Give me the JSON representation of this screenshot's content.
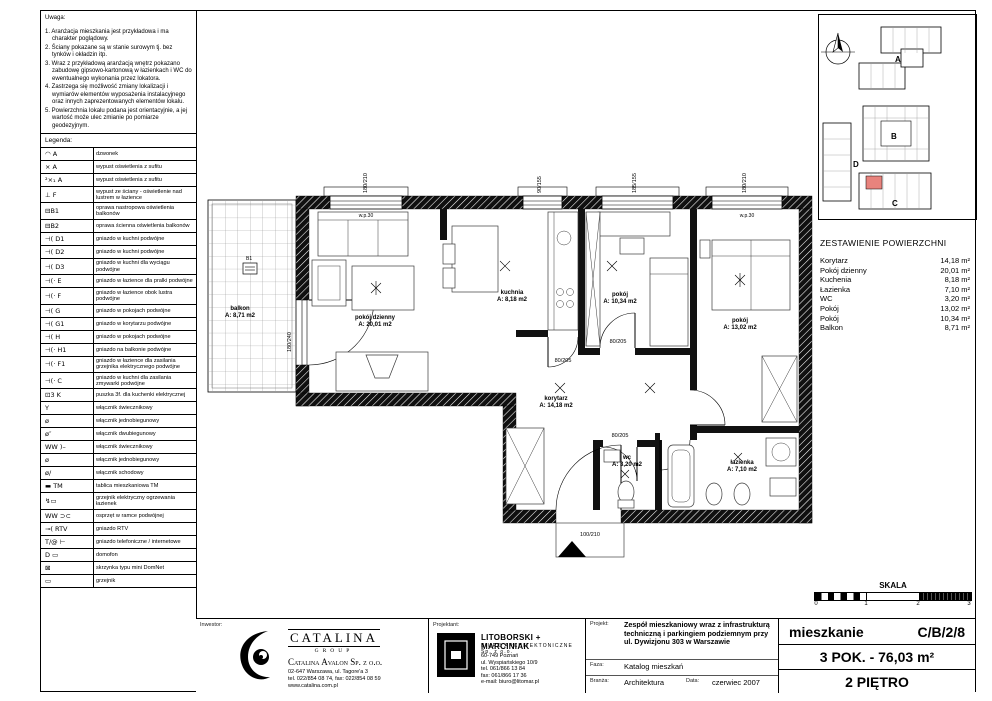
{
  "notes": {
    "title": "Uwaga:",
    "items": [
      "1. Aranżacja mieszkania jest przykładowa i ma charakter poglądowy.",
      "2. Ściany pokazane są w stanie surowym tj. bez tynków i okładzin itp.",
      "3. Wraz z przykładową aranżacją wnętrz pokazano zabudowę gipsowo-kartonową w łazienkach i WC do ewentualnego wykonania przez lokatora.",
      "4. Zastrzega się możliwość zmiany lokalizacji i wymiarów elementów wyposażenia instalacyjnego oraz innych zaprezentowanych elementów lokalu.",
      "5. Powierzchnia lokalu podana jest orientacyjnie, a jej wartość może ulec zmianie po pomiarze geodezyjnym."
    ]
  },
  "legend": {
    "title": "Legenda:",
    "rows": [
      {
        "sym": "◠ A",
        "desc": "dzwonek"
      },
      {
        "sym": "× A",
        "desc": "wypust oświetlenia z sufitu"
      },
      {
        "sym": "²×₁ A",
        "desc": "wypust oświetlenia z sufitu"
      },
      {
        "sym": "⊥ F",
        "desc": "wypust ze ściany - oświetlenie nad lustrem w łazience"
      },
      {
        "sym": "⊟B1",
        "desc": "oprawa nastropowa oświetlenia balkonów"
      },
      {
        "sym": "⊟B2",
        "desc": "oprawa ścienna oświetlenia balkonów"
      },
      {
        "sym": "⊣( D1",
        "desc": "gniazdo w kuchni podwójne"
      },
      {
        "sym": "⊣( D2",
        "desc": "gniazdo w kuchni podwójne"
      },
      {
        "sym": "⊣( D3",
        "desc": "gniazdo w kuchni dla wyciągu podwójne"
      },
      {
        "sym": "⊣(⋅ E",
        "desc": "gniazdo w łazience dla pralki podwójne"
      },
      {
        "sym": "⊣(⋅ F",
        "desc": "gniazdo w łazience obok lustra podwójne"
      },
      {
        "sym": "⊣( G",
        "desc": "gniazdo w pokojach podwójne"
      },
      {
        "sym": "⊣( G1",
        "desc": "gniazdo w korytarzu podwójne"
      },
      {
        "sym": "⊣( H",
        "desc": "gniazdo w pokojach podwójne"
      },
      {
        "sym": "⊣(⋅ H1",
        "desc": "gniazdo na balkonie podwójne"
      },
      {
        "sym": "⊣(⋅ F1",
        "desc": "gniazdo w łazience dla zasilania grzejnika elektrycznego podwójne"
      },
      {
        "sym": "⊣(⋅ C",
        "desc": "gniazdo w kuchni dla zasilania zmywarki podwójne"
      },
      {
        "sym": "⊡3 K",
        "desc": "puszka 3f. dla kuchenki elektrycznej"
      },
      {
        "sym": "Y",
        "desc": "włącznik świecznikowy"
      },
      {
        "sym": "ø",
        "desc": "włącznik jednobiegunowy"
      },
      {
        "sym": "ø″",
        "desc": "włącznik dwubiegunowy"
      },
      {
        "sym": "WW )–",
        "desc": "włącznik świecznikowy"
      },
      {
        "sym": "ø",
        "desc": "włącznik jednobiegunowy"
      },
      {
        "sym": "ø/",
        "desc": "włącznik schodowy"
      },
      {
        "sym": "▬ TM",
        "desc": "tablica mieszkaniowa TM"
      },
      {
        "sym": "↯▭",
        "desc": "grzejnik elektryczny ogrzewania łazienek"
      },
      {
        "sym": "WW ⊃⊂",
        "desc": "osprzęt w ramce podwójnej"
      },
      {
        "sym": "⊸( RTV",
        "desc": "gniazdo RTV"
      },
      {
        "sym": "T/@ ⊢",
        "desc": "gniazdo telefoniczne / internetowe"
      },
      {
        "sym": "D ▭",
        "desc": "domofon"
      },
      {
        "sym": "⊠",
        "desc": "skrzynka typu mini DomNet"
      },
      {
        "sym": "▭",
        "desc": "grzejnik"
      }
    ]
  },
  "site": {
    "a": "A",
    "b": "B",
    "c": "C",
    "d": "D",
    "highlight": "#e8837d"
  },
  "areas": {
    "title": "ZESTAWIENIE POWIERZCHNI",
    "rows": [
      {
        "name": "Korytarz",
        "value": "14,18 m²"
      },
      {
        "name": "Pokój dzienny",
        "value": "20,01 m²"
      },
      {
        "name": "Kuchenia",
        "value": "8,18 m²"
      },
      {
        "name": "Łazienka",
        "value": "7,10 m²"
      },
      {
        "name": "WC",
        "value": "3,20 m²"
      },
      {
        "name": "Pokój",
        "value": "13,02 m²"
      },
      {
        "name": "Pokój",
        "value": "10,34 m²"
      },
      {
        "name": "Balkon",
        "value": "8,71 m²"
      }
    ]
  },
  "plan": {
    "rooms": [
      {
        "name": "pokój dzienny",
        "area": "A: 20,01 m2"
      },
      {
        "name": "kuchnia",
        "area": "A: 8,18 m2"
      },
      {
        "name": "pokój",
        "area": "A: 10,34 m2"
      },
      {
        "name": "pokój",
        "area": "A: 13,02 m2"
      },
      {
        "name": "korytarz",
        "area": "A: 14,18 m2"
      },
      {
        "name": "wc",
        "area": "A: 3,20 m2"
      },
      {
        "name": "łazienka",
        "area": "A: 7,10 m2"
      },
      {
        "name": "balkon",
        "area": "A: 8,71 m2"
      }
    ],
    "dims": {
      "w1": "180/210",
      "w2": "90/155",
      "w3": "185/155",
      "w4": "180/210",
      "balcony_door": "180/240",
      "door": "80/205",
      "entry": "100/210",
      "parapet": "w.p.30"
    },
    "balcony_fixture": "B1"
  },
  "scale": {
    "title": "SKALA",
    "ticks": [
      "0",
      "1",
      "2",
      "3"
    ]
  },
  "tb": {
    "investor_label": "Inwestor:",
    "investor": {
      "brand": "CATALINA",
      "brand_sub": "GROUP",
      "company": "Catalina Avalon Sp. z o.o.",
      "lines": [
        "02-647 Warszawa, ul. Tagore'a 3",
        "tel. 022/854 08 74, fax: 022/854 08 59",
        "www.catalina.com.pl"
      ]
    },
    "designer_label": "Projektant:",
    "designer": {
      "name": "LITOBORSKI + MARCINIAK",
      "sub": "BIURO ARCHITEKTONICZNE Sp. z o.o.",
      "lines": [
        "60-749 Poznań",
        "ul. Wyspiańskiego 10/9",
        "tel. 061/866 13 84",
        "fax: 061/866 17 36",
        "e-mail: biuro@litomar.pl"
      ]
    },
    "project_label": "Projekt:",
    "project": "Zespół mieszkaniowy wraz z infrastrukturą techniczną i parkingiem podziemnym przy ul. Dywizjonu 303 w Warszawie",
    "phase_label": "Faza:",
    "phase": "Katalog mieszkań",
    "branch_label": "Branża:",
    "branch": "Architektura",
    "date_label": "Data:",
    "date": "czerwiec 2007",
    "apartment_label": "mieszkanie",
    "apartment_code": "C/B/2/8",
    "apartment_size": "3 POK. - 76,03 m²",
    "floor": "2 PIĘTRO"
  }
}
